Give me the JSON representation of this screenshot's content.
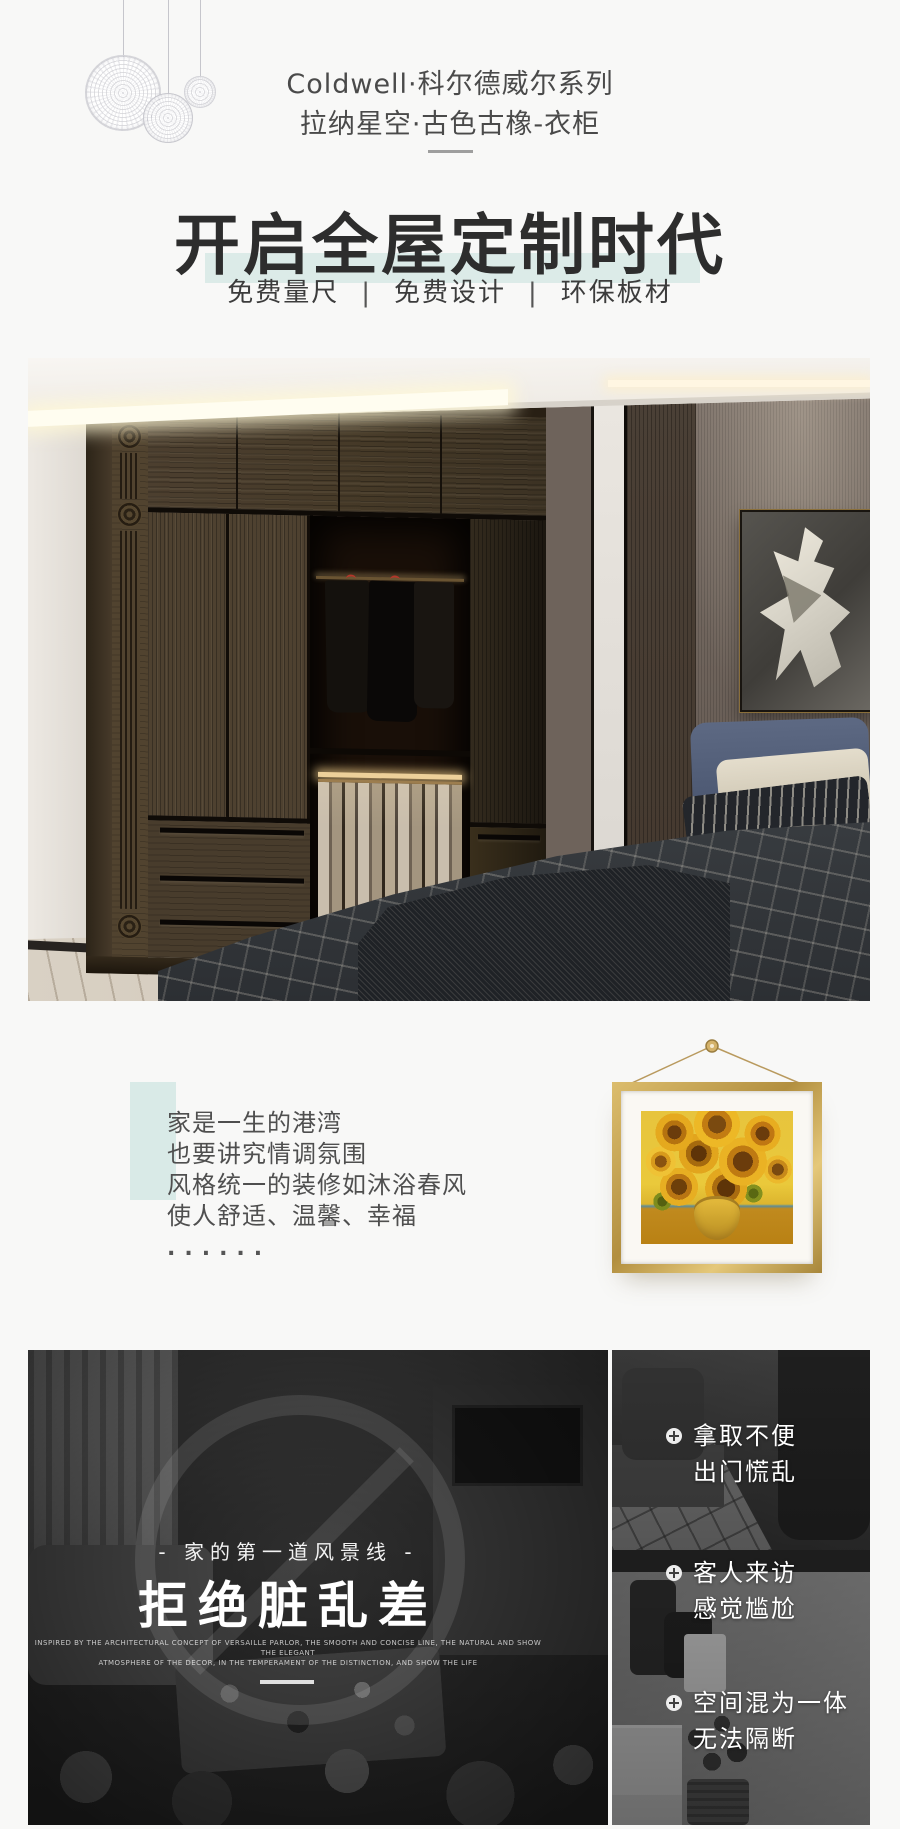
{
  "header": {
    "brand_line1": "Coldwell·科尔德威尔系列",
    "brand_line2": "拉纳星空·古色古橡-衣柜",
    "headline": "开启全屋定制时代",
    "features": [
      "免费量尺",
      "免费设计",
      "环保板材"
    ],
    "feature_separator": "|"
  },
  "intro": {
    "lines": [
      "家是一生的港湾",
      "也要讲究情调氛围",
      "风格统一的装修如沐浴春风",
      "使人舒适、温馨、幸福"
    ],
    "ellipsis": "......"
  },
  "comparison": {
    "tagline": "- 家的第一道风景线 -",
    "title": "拒绝脏乱差",
    "subtext_en_line1": "INSPIRED BY THE ARCHITECTURAL CONCEPT OF VERSAILLE PARLOR, THE SMOOTH AND CONCISE LINE, THE NATURAL AND SHOW THE ELEGANT",
    "subtext_en_line2": "ATMOSPHERE OF THE DECOR, IN THE TEMPERAMENT OF THE DISTINCTION, AND SHOW THE LIFE",
    "pain_points": [
      {
        "line1": "拿取不便",
        "line2": "出门慌乱"
      },
      {
        "line1": "客人来访",
        "line2": "感觉尴尬"
      },
      {
        "line1": "空间混为一体",
        "line2": "无法隔断"
      }
    ]
  },
  "icons": {
    "pain_point_bullet": "circle-plus",
    "watermark": "prohibition-circle",
    "ornament": "dandelion-orb",
    "painting_hanger": "nail-with-string"
  },
  "colors": {
    "page_bg": "#f8f8f7",
    "accent_mint_band": "#dcebe8",
    "teal_block": "#d9eae7",
    "headline_text": "#2d2d2d",
    "frame_gold": "#c3a055",
    "overlay_text": "#ffffff"
  }
}
